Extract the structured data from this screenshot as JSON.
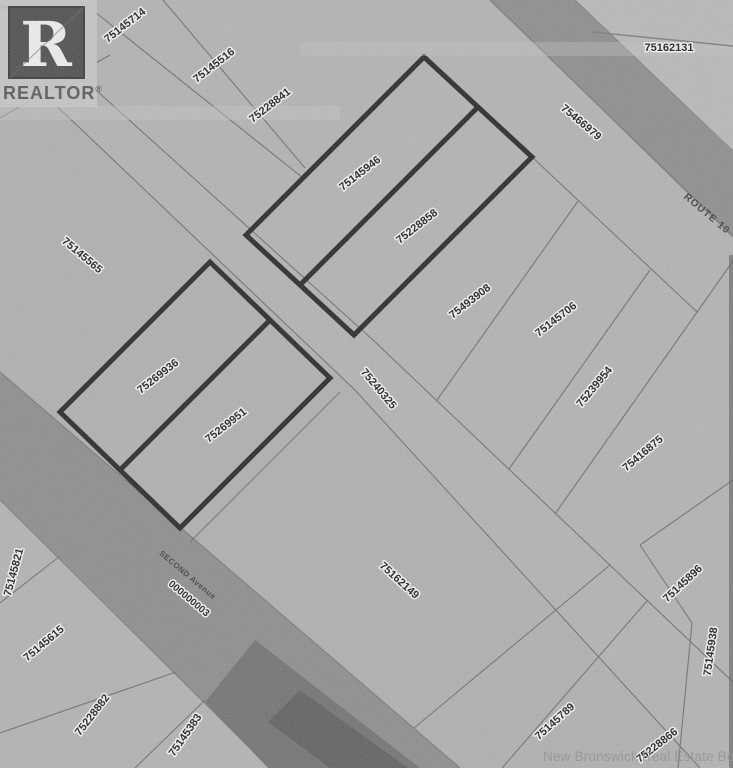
{
  "branding": {
    "logo_r": "R",
    "logo_text": "REALTOR",
    "registered_mark": "®"
  },
  "watermark": {
    "text": "New Brunswick Real Estate Board"
  },
  "roads": {
    "route_label": "ROUTE 10",
    "avenue_label": "SECOND Avenue",
    "avenue_pid": "000000003",
    "street_pid": "75240325"
  },
  "colors": {
    "background": "#b3b3b3",
    "road_fill": "#8d8d8d",
    "road_dark_core": "#6d6d6d",
    "bold_parcel_outline": "#262626",
    "thin_line": "#6f6f6f",
    "label_text": "#1c1c1c",
    "label_halo": "#f4f4f4",
    "watermark_gray": "#8f8f8f"
  },
  "parcels": [
    {
      "pid": "75145714"
    },
    {
      "pid": "75145516"
    },
    {
      "pid": "75228841"
    },
    {
      "pid": "75162131"
    },
    {
      "pid": "75466979"
    },
    {
      "pid": "75145946"
    },
    {
      "pid": "75228858"
    },
    {
      "pid": "75145565"
    },
    {
      "pid": "75493908"
    },
    {
      "pid": "75145706"
    },
    {
      "pid": "75239954"
    },
    {
      "pid": "75416875"
    },
    {
      "pid": "75269936"
    },
    {
      "pid": "75269951"
    },
    {
      "pid": "75162149"
    },
    {
      "pid": "75145821"
    },
    {
      "pid": "75145615"
    },
    {
      "pid": "75228882"
    },
    {
      "pid": "75145383"
    },
    {
      "pid": "75145789"
    },
    {
      "pid": "75228866"
    },
    {
      "pid": "75145896"
    },
    {
      "pid": "75145938"
    }
  ]
}
